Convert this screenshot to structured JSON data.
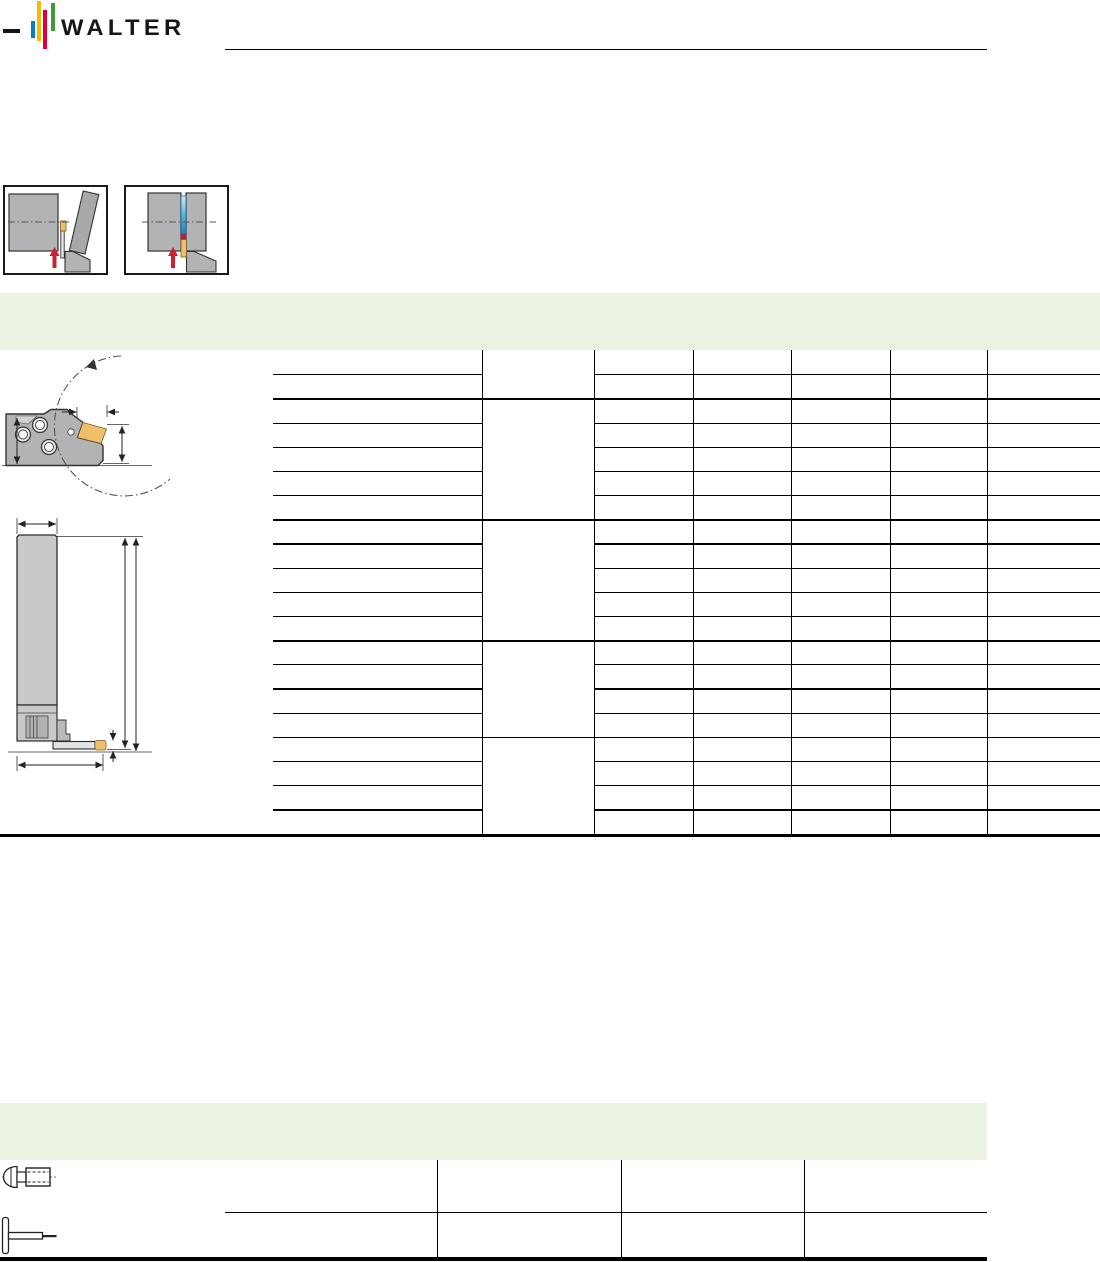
{
  "brand": {
    "wordmark": "WALTER"
  },
  "colors": {
    "logo_blue": "#0d7cbf",
    "logo_yellow": "#f4bc00",
    "logo_red": "#e1003c",
    "logo_green": "#3f9b36",
    "band_green": "#eaf2e2",
    "line_black": "#000000",
    "drawing_gray": "#b1b3b5",
    "drawing_gray_light": "#c7c9ca",
    "drawing_outline": "#333333",
    "insert_gold": "#efc06a",
    "arrow_red": "#cc2133",
    "groove_blue": "#2f9ad4"
  },
  "pictograms": [
    {
      "name": "parting-off-pictogram"
    },
    {
      "name": "grooving-pictogram"
    }
  ],
  "main_table": {
    "row_groups": [
      2,
      5,
      5,
      4,
      4
    ],
    "data_columns": 5,
    "cells_blank": true
  },
  "spare_parts_table": {
    "row_count": 2,
    "data_columns": 3,
    "row_icons": [
      "clamping-screw-icon",
      "torx-key-icon"
    ],
    "cells_blank": true
  }
}
